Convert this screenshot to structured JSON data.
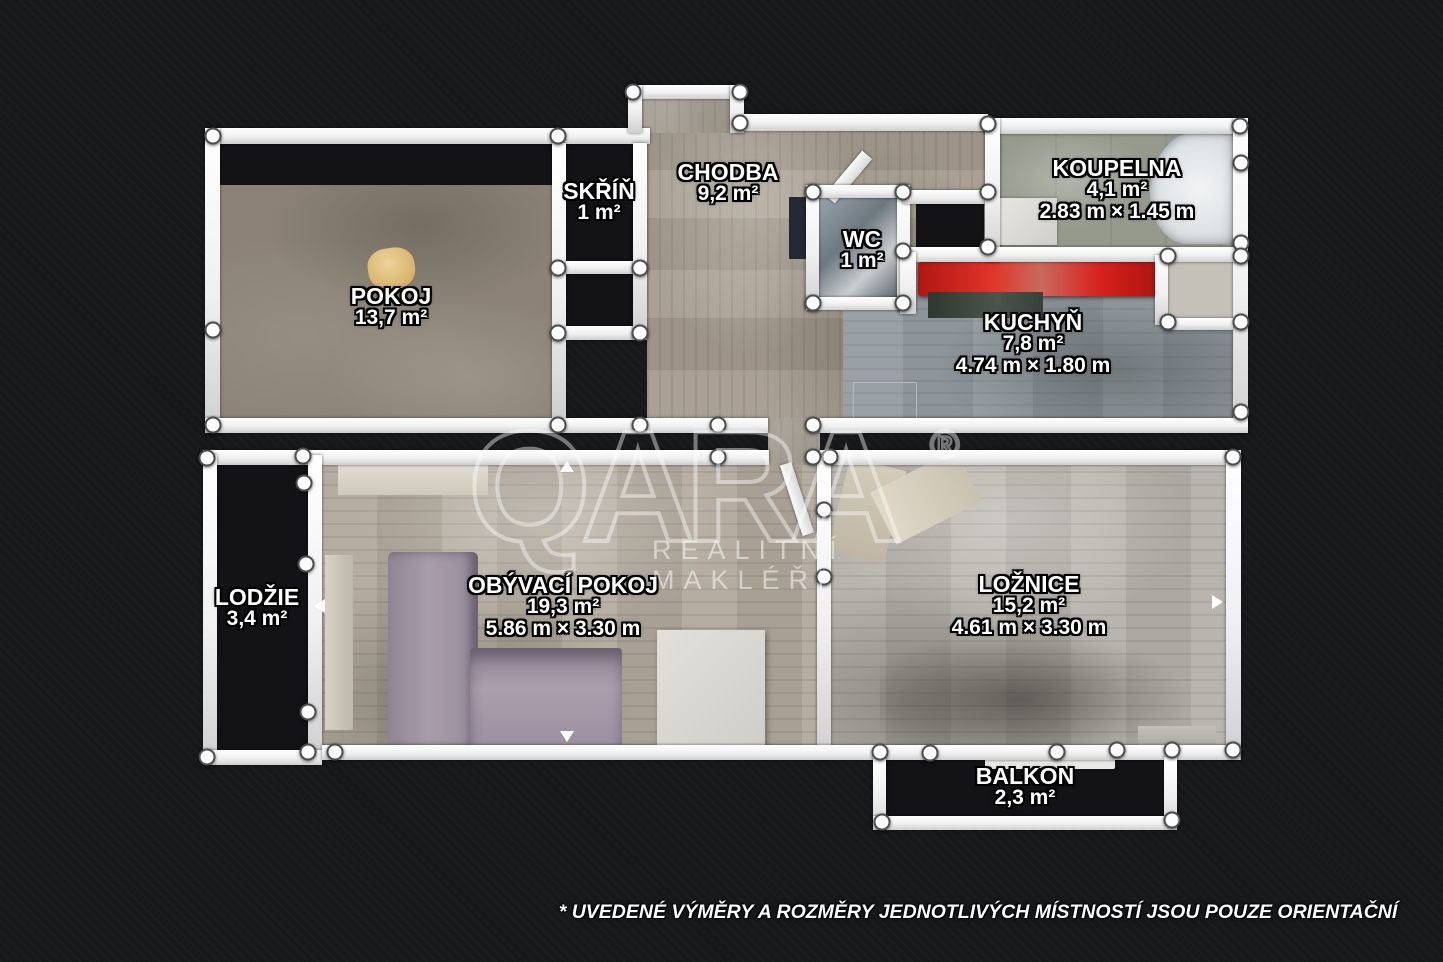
{
  "watermark": {
    "brand": "QARA",
    "registered": "®",
    "tagline": "REALITNÍ MAKLÉŘI"
  },
  "disclaimer": "* UVEDENÉ VÝMĚRY A ROZMĚRY JEDNOTLIVÝCH MÍSTNOSTÍ JSOU POUZE ORIENTAČNÍ",
  "rooms": [
    {
      "name": "POKOJ",
      "area": "13,7 m²"
    },
    {
      "name": "SKŘÍŇ",
      "area": "1 m²"
    },
    {
      "name": "CHODBA",
      "area": "9,2 m²"
    },
    {
      "name": "WC",
      "area": "1 m²"
    },
    {
      "name": "KOUPELNA",
      "area": "4,1 m²",
      "dimensions": "2.83 m × 1.45 m"
    },
    {
      "name": "KUCHYŇ",
      "area": "7,8 m²",
      "dimensions": "4.74 m × 1.80 m"
    },
    {
      "name": "LODŽIE",
      "area": "3,4 m²"
    },
    {
      "name": "OBÝVACÍ POKOJ",
      "area": "19,3 m²",
      "dimensions": "5.86 m × 3.30 m"
    },
    {
      "name": "LOŽNICE",
      "area": "15,2 m²",
      "dimensions": "4.61 m × 3.30 m"
    },
    {
      "name": "BALKON",
      "area": "2,3 m²"
    }
  ],
  "colors": {
    "background": "#17181a",
    "wall": "#f2f2f2",
    "label_text": "#ffffff",
    "kitchen_counter": "#c9231f",
    "watermark": "rgba(255,255,255,0.5)"
  }
}
